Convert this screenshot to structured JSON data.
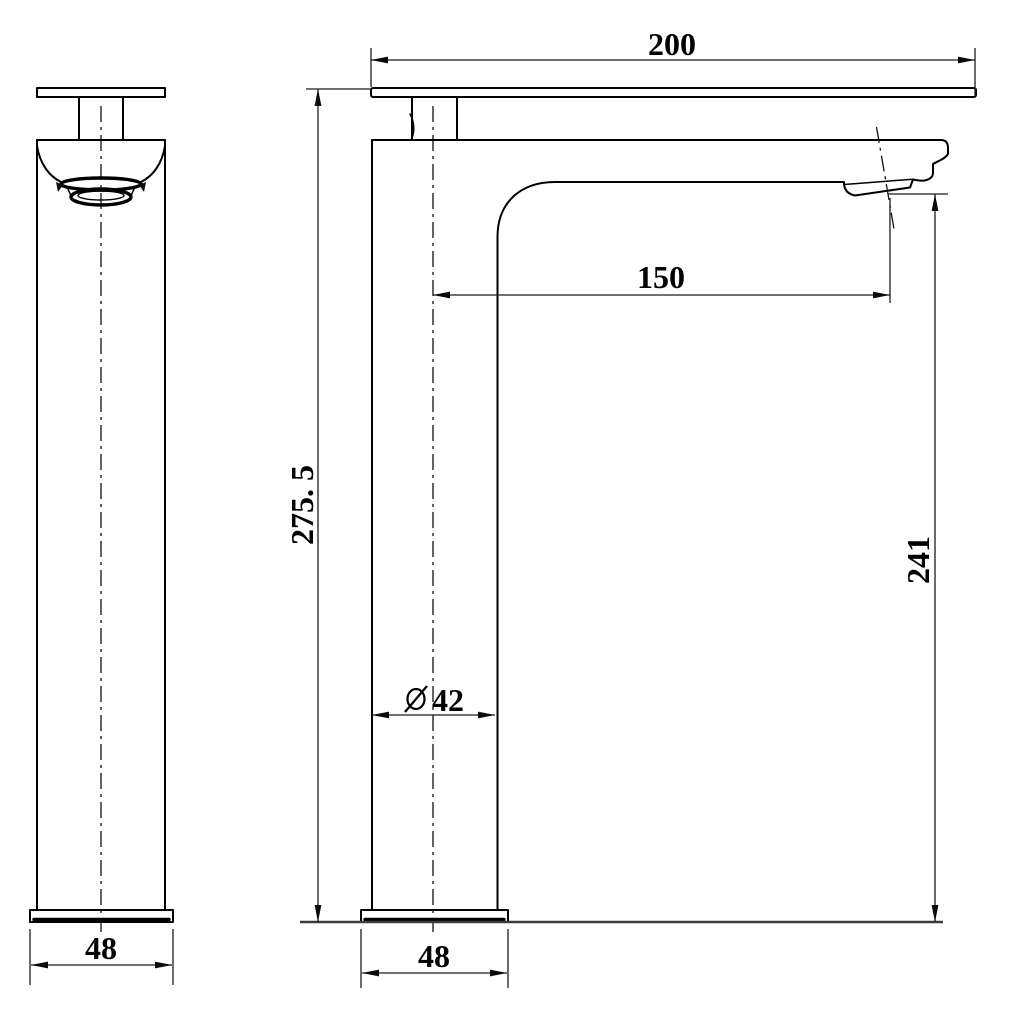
{
  "drawing": {
    "type": "technical-drawing",
    "subject": "tall vessel basin faucet, two-view dimensioned drawing",
    "views": {
      "front_view": "faucet front elevation",
      "side_view": "faucet side elevation"
    },
    "labels": {
      "lever_length": "200",
      "spout_reach": "150",
      "overall_height": "275. 5",
      "outlet_height": "241",
      "diameter_symbol": "⌀",
      "body_diameter": "42",
      "base_width_front": "48",
      "base_width_side": "48"
    },
    "colors": {
      "background": "#ffffff",
      "object_line": "#000000",
      "dimension_line": "#1c1c1c",
      "ground_line": "#3c3c3c"
    }
  }
}
